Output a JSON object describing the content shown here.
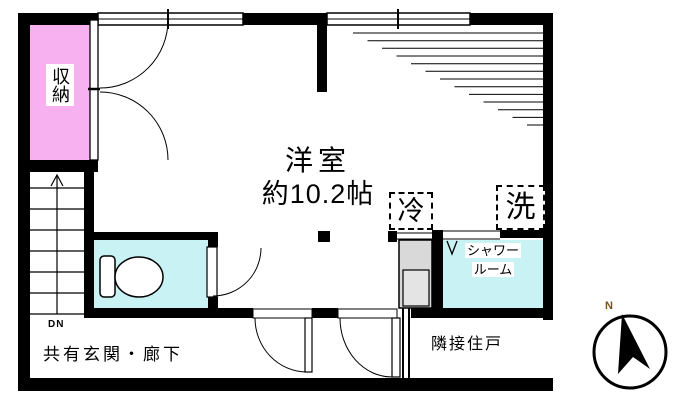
{
  "labels": {
    "storage": "収納",
    "room_name": "洋室",
    "room_size": "約10.2帖",
    "fridge": "冷",
    "laundry": "洗",
    "shower_line1": "シャワー",
    "shower_line2": "ルーム",
    "stairs_down": "DN",
    "corridor": "共有玄関・廊下",
    "adjacent_unit": "隣接住戸",
    "compass_north": "N"
  },
  "colors": {
    "storage_fill": "#f7b0f0",
    "wet_room_fill": "#c9f2f4",
    "fixture_fill": "#d9d9d9",
    "fixture_inner_fill": "#e4e4e4",
    "wall": "#000000",
    "north_label": "#7b4f1b"
  }
}
